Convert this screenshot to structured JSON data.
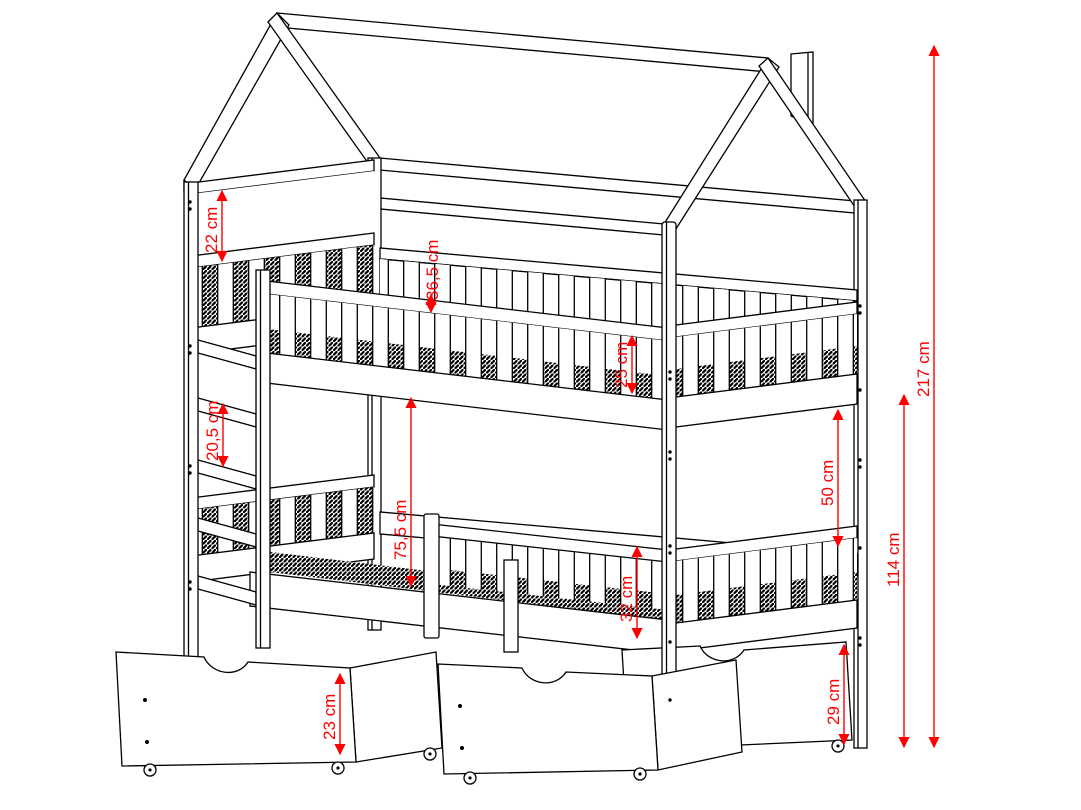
{
  "diagram": {
    "type": "technical-dimension-drawing",
    "subject": "house-frame bunk bed with guardrails, ladder and rolling storage drawers",
    "unit": "cm",
    "colors": {
      "lines": "#000000",
      "dimensions": "#ff0000",
      "background": "#ffffff"
    },
    "dimensions": [
      {
        "id": "headboard-wall-height",
        "label": "22 cm",
        "value": 22
      },
      {
        "id": "upper-side-rail-height",
        "label": "36,5 cm",
        "value": 36.5
      },
      {
        "id": "upper-guardrail-height",
        "label": "25 cm",
        "value": 25
      },
      {
        "id": "ladder-rung-spacing",
        "label": "20,5 cm",
        "value": 20.5
      },
      {
        "id": "space-between-bunks",
        "label": "75,5 cm",
        "value": 75.5
      },
      {
        "id": "clearance-under-upper-bunk",
        "label": "50 cm",
        "value": 50
      },
      {
        "id": "total-height",
        "label": "217 cm",
        "value": 217
      },
      {
        "id": "upper-bunk-height",
        "label": "114 cm",
        "value": 114
      },
      {
        "id": "lower-guardrail-height",
        "label": "32 cm",
        "value": 32
      },
      {
        "id": "drawer-front-height",
        "label": "23 cm",
        "value": 23
      },
      {
        "id": "clearance-under-bed",
        "label": "29 cm",
        "value": 29
      }
    ]
  }
}
